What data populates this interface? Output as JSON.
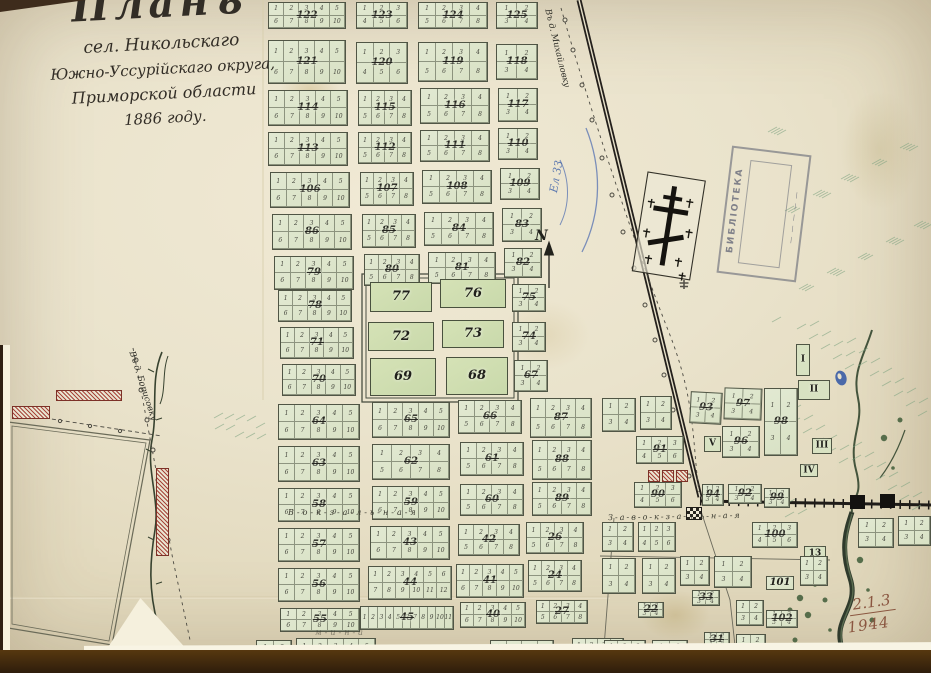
{
  "map": {
    "title": {
      "line1": "Планъ",
      "line2": "сел. Никольскаго",
      "line3": "Южно-Уссурійскаго округа,",
      "line4": "Приморской области",
      "line5": "1886 году."
    },
    "north_label": "N",
    "streets": {
      "vokzalnaya": "В-о-к-з-а-л-ь-н-а-я",
      "zavokzalnaya": "З-а-в-о-к-з-а-л-ь-н-а-я",
      "faint_south": "м-и-н-а"
    },
    "roads": {
      "north_road": "Въ д. Михайловку",
      "west_road": "Въ д. Борисовку"
    },
    "stamp": {
      "line1": "БИБЛІОТЕКА",
      "line2": "— — — — —"
    },
    "annotations": {
      "blue_note": "Ел 33",
      "archive_ref": "2.1.3",
      "archive_year": "1944"
    },
    "lot_numbering_note": "lots numbered 1..N on top row, N+1..2N on bottom row",
    "blocks": [
      {
        "n": "122",
        "x": 268,
        "y": 2,
        "w": 78,
        "h": 27,
        "c": 5
      },
      {
        "n": "123",
        "x": 356,
        "y": 2,
        "w": 52,
        "h": 27,
        "c": 3
      },
      {
        "n": "124",
        "x": 418,
        "y": 2,
        "w": 70,
        "h": 27,
        "c": 4
      },
      {
        "n": "125",
        "x": 496,
        "y": 2,
        "w": 42,
        "h": 27,
        "c": 2
      },
      {
        "n": "121",
        "x": 268,
        "y": 40,
        "w": 78,
        "h": 44,
        "c": 5
      },
      {
        "n": "120",
        "x": 356,
        "y": 42,
        "w": 52,
        "h": 42,
        "c": 3
      },
      {
        "n": "119",
        "x": 418,
        "y": 42,
        "w": 70,
        "h": 40,
        "c": 4
      },
      {
        "n": "118",
        "x": 496,
        "y": 44,
        "w": 42,
        "h": 36,
        "c": 2
      },
      {
        "n": "114",
        "x": 268,
        "y": 90,
        "w": 80,
        "h": 36,
        "c": 5
      },
      {
        "n": "115",
        "x": 358,
        "y": 90,
        "w": 54,
        "h": 36,
        "c": 4
      },
      {
        "n": "116",
        "x": 420,
        "y": 88,
        "w": 70,
        "h": 36,
        "c": 4
      },
      {
        "n": "117",
        "x": 498,
        "y": 88,
        "w": 40,
        "h": 34,
        "c": 2
      },
      {
        "n": "113",
        "x": 268,
        "y": 132,
        "w": 80,
        "h": 34,
        "c": 5
      },
      {
        "n": "112",
        "x": 358,
        "y": 132,
        "w": 54,
        "h": 32,
        "c": 4
      },
      {
        "n": "111",
        "x": 420,
        "y": 130,
        "w": 70,
        "h": 32,
        "c": 4
      },
      {
        "n": "110",
        "x": 498,
        "y": 128,
        "w": 40,
        "h": 32,
        "c": 2
      },
      {
        "n": "106",
        "x": 270,
        "y": 172,
        "w": 80,
        "h": 36,
        "c": 5
      },
      {
        "n": "107",
        "x": 360,
        "y": 172,
        "w": 54,
        "h": 34,
        "c": 4
      },
      {
        "n": "108",
        "x": 422,
        "y": 170,
        "w": 70,
        "h": 34,
        "c": 4
      },
      {
        "n": "109",
        "x": 500,
        "y": 168,
        "w": 40,
        "h": 32,
        "c": 2
      },
      {
        "n": "86",
        "x": 272,
        "y": 214,
        "w": 80,
        "h": 36,
        "c": 5
      },
      {
        "n": "85",
        "x": 362,
        "y": 214,
        "w": 54,
        "h": 34,
        "c": 4
      },
      {
        "n": "84",
        "x": 424,
        "y": 212,
        "w": 70,
        "h": 34,
        "c": 4
      },
      {
        "n": "83",
        "x": 502,
        "y": 208,
        "w": 40,
        "h": 34,
        "c": 2
      },
      {
        "n": "79",
        "x": 274,
        "y": 256,
        "w": 80,
        "h": 34,
        "c": 5
      },
      {
        "n": "80",
        "x": 364,
        "y": 254,
        "w": 56,
        "h": 32,
        "c": 4
      },
      {
        "n": "81",
        "x": 428,
        "y": 252,
        "w": 68,
        "h": 32,
        "c": 4
      },
      {
        "n": "82",
        "x": 504,
        "y": 248,
        "w": 38,
        "h": 30,
        "c": 2
      },
      {
        "n": "78",
        "x": 278,
        "y": 290,
        "w": 74,
        "h": 32,
        "c": 5
      },
      {
        "n": "71",
        "x": 280,
        "y": 327,
        "w": 74,
        "h": 32,
        "c": 5
      },
      {
        "n": "70",
        "x": 282,
        "y": 364,
        "w": 74,
        "h": 32,
        "c": 5
      },
      {
        "n": "75",
        "x": 512,
        "y": 284,
        "w": 34,
        "h": 28,
        "c": 2
      },
      {
        "n": "74",
        "x": 512,
        "y": 322,
        "w": 34,
        "h": 30,
        "c": 2
      },
      {
        "n": "67",
        "x": 514,
        "y": 360,
        "w": 34,
        "h": 32,
        "c": 2
      },
      {
        "n": "77",
        "x": 370,
        "y": 282,
        "w": 62,
        "h": 30,
        "t": "g"
      },
      {
        "n": "76",
        "x": 440,
        "y": 279,
        "w": 66,
        "h": 29,
        "t": "g"
      },
      {
        "n": "72",
        "x": 368,
        "y": 322,
        "w": 66,
        "h": 29,
        "t": "g"
      },
      {
        "n": "73",
        "x": 442,
        "y": 320,
        "w": 62,
        "h": 28,
        "t": "g"
      },
      {
        "n": "69",
        "x": 370,
        "y": 358,
        "w": 66,
        "h": 38,
        "t": "g"
      },
      {
        "n": "68",
        "x": 446,
        "y": 357,
        "w": 62,
        "h": 38,
        "t": "g"
      },
      {
        "n": "64",
        "x": 278,
        "y": 404,
        "w": 82,
        "h": 36,
        "c": 5
      },
      {
        "n": "65",
        "x": 372,
        "y": 402,
        "w": 78,
        "h": 36,
        "c": 5
      },
      {
        "n": "66",
        "x": 458,
        "y": 400,
        "w": 64,
        "h": 34,
        "c": 4
      },
      {
        "n": "87",
        "x": 530,
        "y": 398,
        "w": 62,
        "h": 40,
        "c": 4
      },
      {
        "n": "63",
        "x": 278,
        "y": 446,
        "w": 82,
        "h": 36,
        "c": 5
      },
      {
        "n": "62",
        "x": 372,
        "y": 444,
        "w": 78,
        "h": 36,
        "c": 4
      },
      {
        "n": "61",
        "x": 460,
        "y": 442,
        "w": 64,
        "h": 34,
        "c": 4
      },
      {
        "n": "88",
        "x": 532,
        "y": 440,
        "w": 60,
        "h": 40,
        "c": 4
      },
      {
        "n": "58",
        "x": 278,
        "y": 488,
        "w": 82,
        "h": 34,
        "c": 5
      },
      {
        "n": "59",
        "x": 372,
        "y": 486,
        "w": 78,
        "h": 34,
        "c": 5
      },
      {
        "n": "60",
        "x": 460,
        "y": 484,
        "w": 64,
        "h": 32,
        "c": 4
      },
      {
        "n": "89",
        "x": 532,
        "y": 482,
        "w": 60,
        "h": 34,
        "c": 4
      },
      {
        "n": "57",
        "x": 278,
        "y": 528,
        "w": 82,
        "h": 34,
        "c": 5
      },
      {
        "n": "43",
        "x": 370,
        "y": 526,
        "w": 80,
        "h": 34,
        "c": 5
      },
      {
        "n": "42",
        "x": 458,
        "y": 524,
        "w": 62,
        "h": 32,
        "c": 4
      },
      {
        "n": "26",
        "x": 526,
        "y": 522,
        "w": 58,
        "h": 32,
        "c": 4
      },
      {
        "n": "56",
        "x": 278,
        "y": 568,
        "w": 82,
        "h": 34,
        "c": 5
      },
      {
        "n": "44",
        "x": 368,
        "y": 566,
        "w": 84,
        "h": 34,
        "c": 6
      },
      {
        "n": "41",
        "x": 456,
        "y": 564,
        "w": 68,
        "h": 34,
        "c": 5
      },
      {
        "n": "24",
        "x": 528,
        "y": 560,
        "w": 54,
        "h": 32,
        "c": 4
      },
      {
        "n": "55",
        "x": 280,
        "y": 608,
        "w": 80,
        "h": 24,
        "c": 5
      },
      {
        "n": "45",
        "x": 360,
        "y": 606,
        "w": 94,
        "h": 24,
        "c": 11,
        "rows": 1
      },
      {
        "n": "40",
        "x": 460,
        "y": 602,
        "w": 66,
        "h": 26,
        "c": 5
      },
      {
        "n": "27",
        "x": 536,
        "y": 600,
        "w": 52,
        "h": 24,
        "c": 4
      },
      {
        "n": "134",
        "x": 120,
        "y": 640,
        "w": 42,
        "h": 28,
        "c": 2
      },
      {
        "n": "34",
        "x": 256,
        "y": 640,
        "w": 36,
        "h": 30,
        "c": 2
      },
      {
        "n": "54",
        "x": 296,
        "y": 638,
        "w": 80,
        "h": 32,
        "c": 5
      },
      {
        "n": "46",
        "x": 408,
        "y": 648,
        "w": 40,
        "h": 23,
        "t": "free"
      },
      {
        "n": "39",
        "x": 490,
        "y": 640,
        "w": 64,
        "h": 30,
        "c": 4
      },
      {
        "n": "28",
        "x": 572,
        "y": 638,
        "w": 52,
        "h": 30,
        "c": 4
      },
      {
        "n": "93",
        "x": 690,
        "y": 392,
        "w": 32,
        "h": 32,
        "c": 2,
        "rot": 3
      },
      {
        "n": "97",
        "x": 724,
        "y": 388,
        "w": 38,
        "h": 32,
        "c": 2,
        "rot": 2
      },
      {
        "n": "98",
        "x": 764,
        "y": 388,
        "w": 34,
        "h": 68,
        "c": 2
      },
      {
        "n": "96",
        "x": 722,
        "y": 426,
        "w": 38,
        "h": 32,
        "c": 2
      },
      {
        "n": "91",
        "x": 636,
        "y": 436,
        "w": 48,
        "h": 28,
        "c": 3
      },
      {
        "n": "90",
        "x": 634,
        "y": 482,
        "w": 48,
        "h": 26,
        "c": 3
      },
      {
        "n": "94",
        "x": 702,
        "y": 484,
        "w": 22,
        "h": 22,
        "c": 2
      },
      {
        "n": "92",
        "x": 728,
        "y": 484,
        "w": 34,
        "h": 20,
        "c": 2
      },
      {
        "n": "99",
        "x": 764,
        "y": 488,
        "w": 26,
        "h": 20,
        "c": 2
      },
      {
        "n": "100",
        "x": 752,
        "y": 522,
        "w": 46,
        "h": 26,
        "c": 3
      },
      {
        "n": "I",
        "x": 796,
        "y": 344,
        "w": 14,
        "h": 32,
        "t": "r"
      },
      {
        "n": "II",
        "x": 798,
        "y": 380,
        "w": 32,
        "h": 20,
        "t": "r"
      },
      {
        "n": "III",
        "x": 812,
        "y": 438,
        "w": 20,
        "h": 16,
        "t": "r"
      },
      {
        "n": "IV",
        "x": 800,
        "y": 464,
        "w": 18,
        "h": 13,
        "t": "r"
      },
      {
        "n": "V",
        "x": 704,
        "y": 436,
        "w": 17,
        "h": 16,
        "t": "r"
      },
      {
        "n": "13",
        "x": 804,
        "y": 546,
        "w": 22,
        "h": 15,
        "t": "r"
      },
      {
        "n": "33",
        "x": 692,
        "y": 590,
        "w": 28,
        "h": 16,
        "c": 2
      },
      {
        "n": "22",
        "x": 638,
        "y": 602,
        "w": 26,
        "h": 16,
        "c": 2
      },
      {
        "n": "31",
        "x": 704,
        "y": 632,
        "w": 26,
        "h": 16,
        "c": 2
      },
      {
        "n": "101",
        "x": 766,
        "y": 576,
        "w": 28,
        "h": 14,
        "t": "p"
      },
      {
        "n": "102",
        "x": 766,
        "y": 610,
        "w": 32,
        "h": 18,
        "c": 2
      },
      {
        "n": "",
        "x": 602,
        "y": 398,
        "w": 34,
        "h": 34,
        "c": 2
      },
      {
        "n": "",
        "x": 640,
        "y": 396,
        "w": 32,
        "h": 34,
        "c": 2
      },
      {
        "n": "",
        "x": 602,
        "y": 522,
        "w": 32,
        "h": 30,
        "c": 2
      },
      {
        "n": "",
        "x": 638,
        "y": 522,
        "w": 38,
        "h": 30,
        "c": 3
      },
      {
        "n": "",
        "x": 602,
        "y": 558,
        "w": 34,
        "h": 36,
        "c": 2
      },
      {
        "n": "",
        "x": 642,
        "y": 558,
        "w": 34,
        "h": 36,
        "c": 2
      },
      {
        "n": "",
        "x": 680,
        "y": 556,
        "w": 30,
        "h": 30,
        "c": 2
      },
      {
        "n": "",
        "x": 714,
        "y": 556,
        "w": 38,
        "h": 32,
        "c": 2
      },
      {
        "n": "",
        "x": 800,
        "y": 556,
        "w": 28,
        "h": 30,
        "c": 2
      },
      {
        "n": "",
        "x": 736,
        "y": 600,
        "w": 28,
        "h": 26,
        "c": 2
      },
      {
        "n": "",
        "x": 604,
        "y": 640,
        "w": 42,
        "h": 26,
        "c": 3
      },
      {
        "n": "",
        "x": 652,
        "y": 640,
        "w": 36,
        "h": 26,
        "c": 2
      },
      {
        "n": "",
        "x": 736,
        "y": 634,
        "w": 30,
        "h": 24,
        "c": 2
      },
      {
        "n": "",
        "x": 858,
        "y": 518,
        "w": 36,
        "h": 30,
        "c": 2
      },
      {
        "n": "",
        "x": 898,
        "y": 516,
        "w": 33,
        "h": 30,
        "c": 2
      },
      {
        "n": "",
        "x": 648,
        "y": 470,
        "w": 12,
        "h": 12,
        "t": "h"
      },
      {
        "n": "",
        "x": 662,
        "y": 470,
        "w": 12,
        "h": 12,
        "t": "h"
      },
      {
        "n": "",
        "x": 676,
        "y": 470,
        "w": 12,
        "h": 12,
        "t": "h"
      },
      {
        "n": "",
        "x": 12,
        "y": 406,
        "w": 38,
        "h": 13,
        "t": "h"
      },
      {
        "n": "",
        "x": 56,
        "y": 390,
        "w": 66,
        "h": 11,
        "t": "h"
      },
      {
        "n": "",
        "x": 156,
        "y": 468,
        "w": 13,
        "h": 88,
        "t": "h"
      },
      {
        "n": "",
        "x": 686,
        "y": 507,
        "w": 16,
        "h": 13,
        "t": "chk"
      }
    ]
  }
}
